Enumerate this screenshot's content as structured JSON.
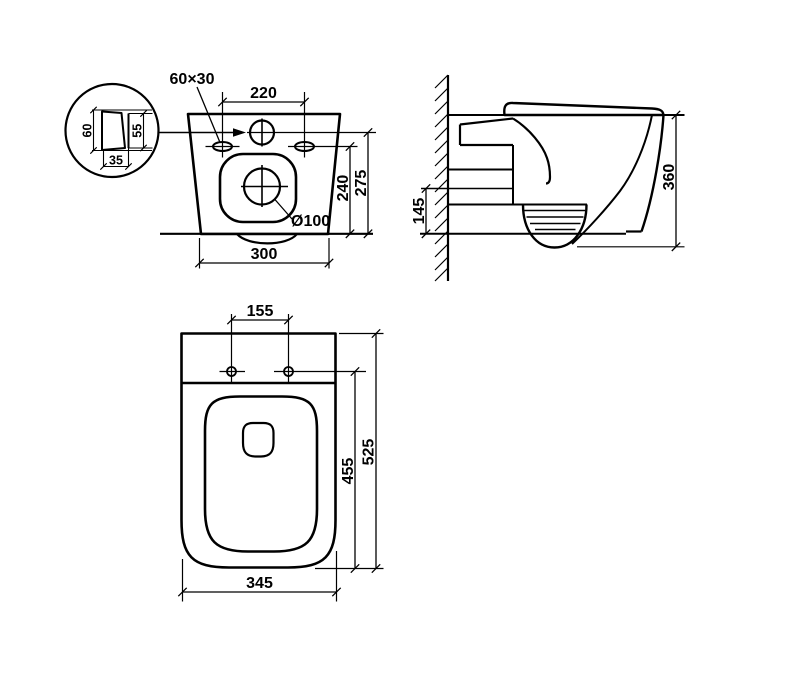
{
  "drawing": {
    "line_color": "#000000",
    "background": "#ffffff",
    "rear_view": {
      "slot_size_label": "60×30",
      "dim_220": "220",
      "dim_240": "240",
      "dim_275": "275",
      "dim_300": "300",
      "drain_label": "Ø100",
      "detail": {
        "dim_60": "60",
        "dim_55": "55",
        "dim_35": "35"
      }
    },
    "side_view": {
      "dim_145": "145",
      "dim_360": "360"
    },
    "top_view": {
      "dim_155": "155",
      "dim_455": "455",
      "dim_525": "525",
      "dim_345": "345"
    }
  }
}
